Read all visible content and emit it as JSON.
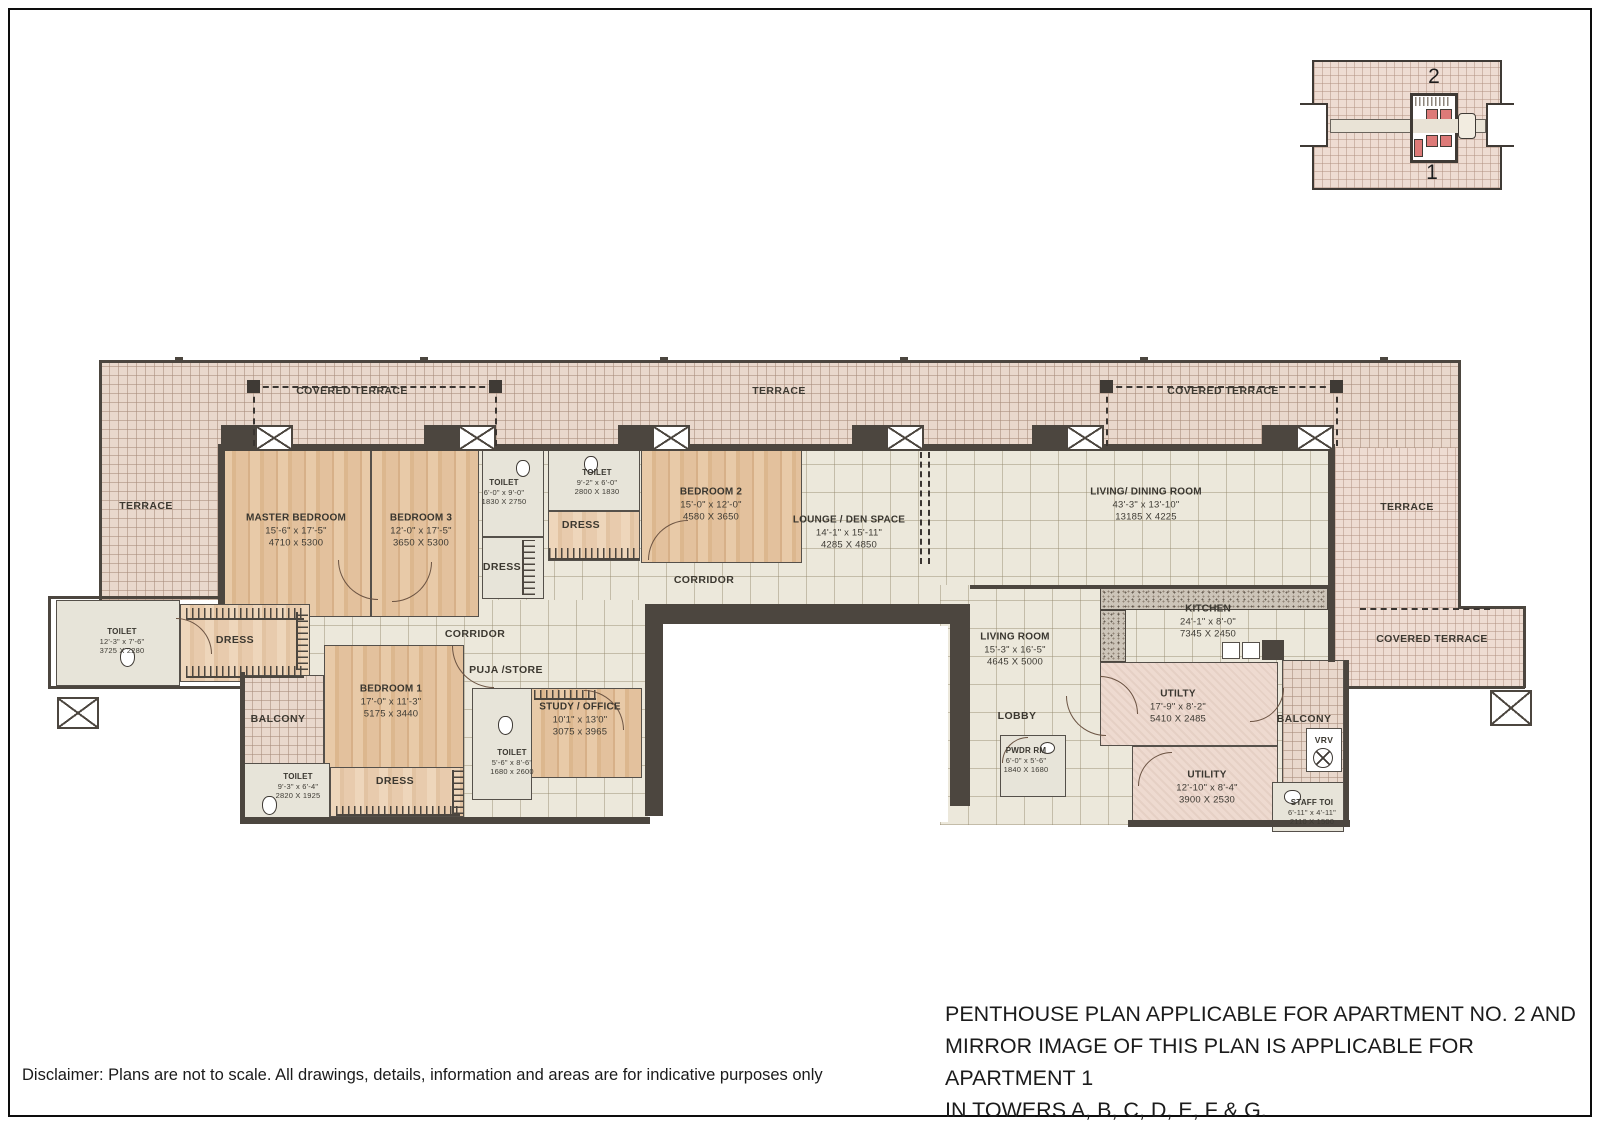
{
  "key_plan": {
    "apartment_top": "2",
    "apartment_bottom": "1"
  },
  "areas": {
    "covered_terrace": "COVERED TERRACE",
    "terrace": "TERRACE",
    "dress": "DRESS",
    "corridor": "CORRIDOR",
    "balcony": "BALCONY",
    "puja_store": "PUJA /STORE",
    "lobby": "LOBBY",
    "vrv": "VRV"
  },
  "rooms": [
    {
      "name": "MASTER BEDROOM",
      "ft": "15'-6\" x 17'-5\"",
      "mm": "4710 x 5300"
    },
    {
      "name": "BEDROOM 3",
      "ft": "12'-0\" x 17'-5\"",
      "mm": "3650 X 5300"
    },
    {
      "name": "TOILET",
      "ft": "6'-0\" x 9'-0\"",
      "mm": "1830 X 2750"
    },
    {
      "name": "TOILET",
      "ft": "9'-2\" x 6'-0\"",
      "mm": "2800 X 1830"
    },
    {
      "name": "BEDROOM 2",
      "ft": "15'-0\" x 12'-0\"",
      "mm": "4580 X 3650"
    },
    {
      "name": "LOUNGE / DEN SPACE",
      "ft": "14'-1\" x 15'-11\"",
      "mm": "4285 X 4850"
    },
    {
      "name": "LIVING/ DINING ROOM",
      "ft": "43'-3\" x 13'-10\"",
      "mm": "13185 X 4225"
    },
    {
      "name": "TOILET",
      "ft": "12'-3\" x 7'-6\"",
      "mm": "3725 X 2280"
    },
    {
      "name": "BEDROOM 1",
      "ft": "17'-0\" x 11'-3\"",
      "mm": "5175 x 3440"
    },
    {
      "name": "STUDY / OFFICE",
      "ft": "10'1\" x 13'0\"",
      "mm": "3075 x 3965"
    },
    {
      "name": "TOILET",
      "ft": "5'-6\" x 8'-6\"",
      "mm": "1680 x 2600"
    },
    {
      "name": "TOILET",
      "ft": "9'-3\" x 6'-4\"",
      "mm": "2820 X 1925"
    },
    {
      "name": "LIVING ROOM",
      "ft": "15'-3\" x 16'-5\"",
      "mm": "4645 X 5000"
    },
    {
      "name": "KITCHEN",
      "ft": "24'-1\" x 8'-0\"",
      "mm": "7345 X 2450"
    },
    {
      "name": "PWDR RM",
      "ft": "6'-0\" x 5'-6\"",
      "mm": "1840 X 1680"
    },
    {
      "name": "UTILTY",
      "ft": "17'-9\" x 8'-2\"",
      "mm": "5410 X 2485"
    },
    {
      "name": "UTILITY",
      "ft": "12'-10\" x 8'-4\"",
      "mm": "3900 X 2530"
    },
    {
      "name": "STAFF TOI",
      "ft": "6'-11\" x 4'-11\"",
      "mm": "2110 X 1500"
    }
  ],
  "notes": {
    "line1": "PENTHOUSE PLAN APPLICABLE FOR APARTMENT NO. 2 AND",
    "line2": "MIRROR IMAGE OF THIS PLAN IS APPLICABLE FOR APARTMENT 1",
    "line3": "IN TOWERS A, B, C, D, E, F & G.",
    "disclaimer": "Disclaimer: Plans are not to scale. All drawings, details, information and areas are for indicative purposes only"
  }
}
